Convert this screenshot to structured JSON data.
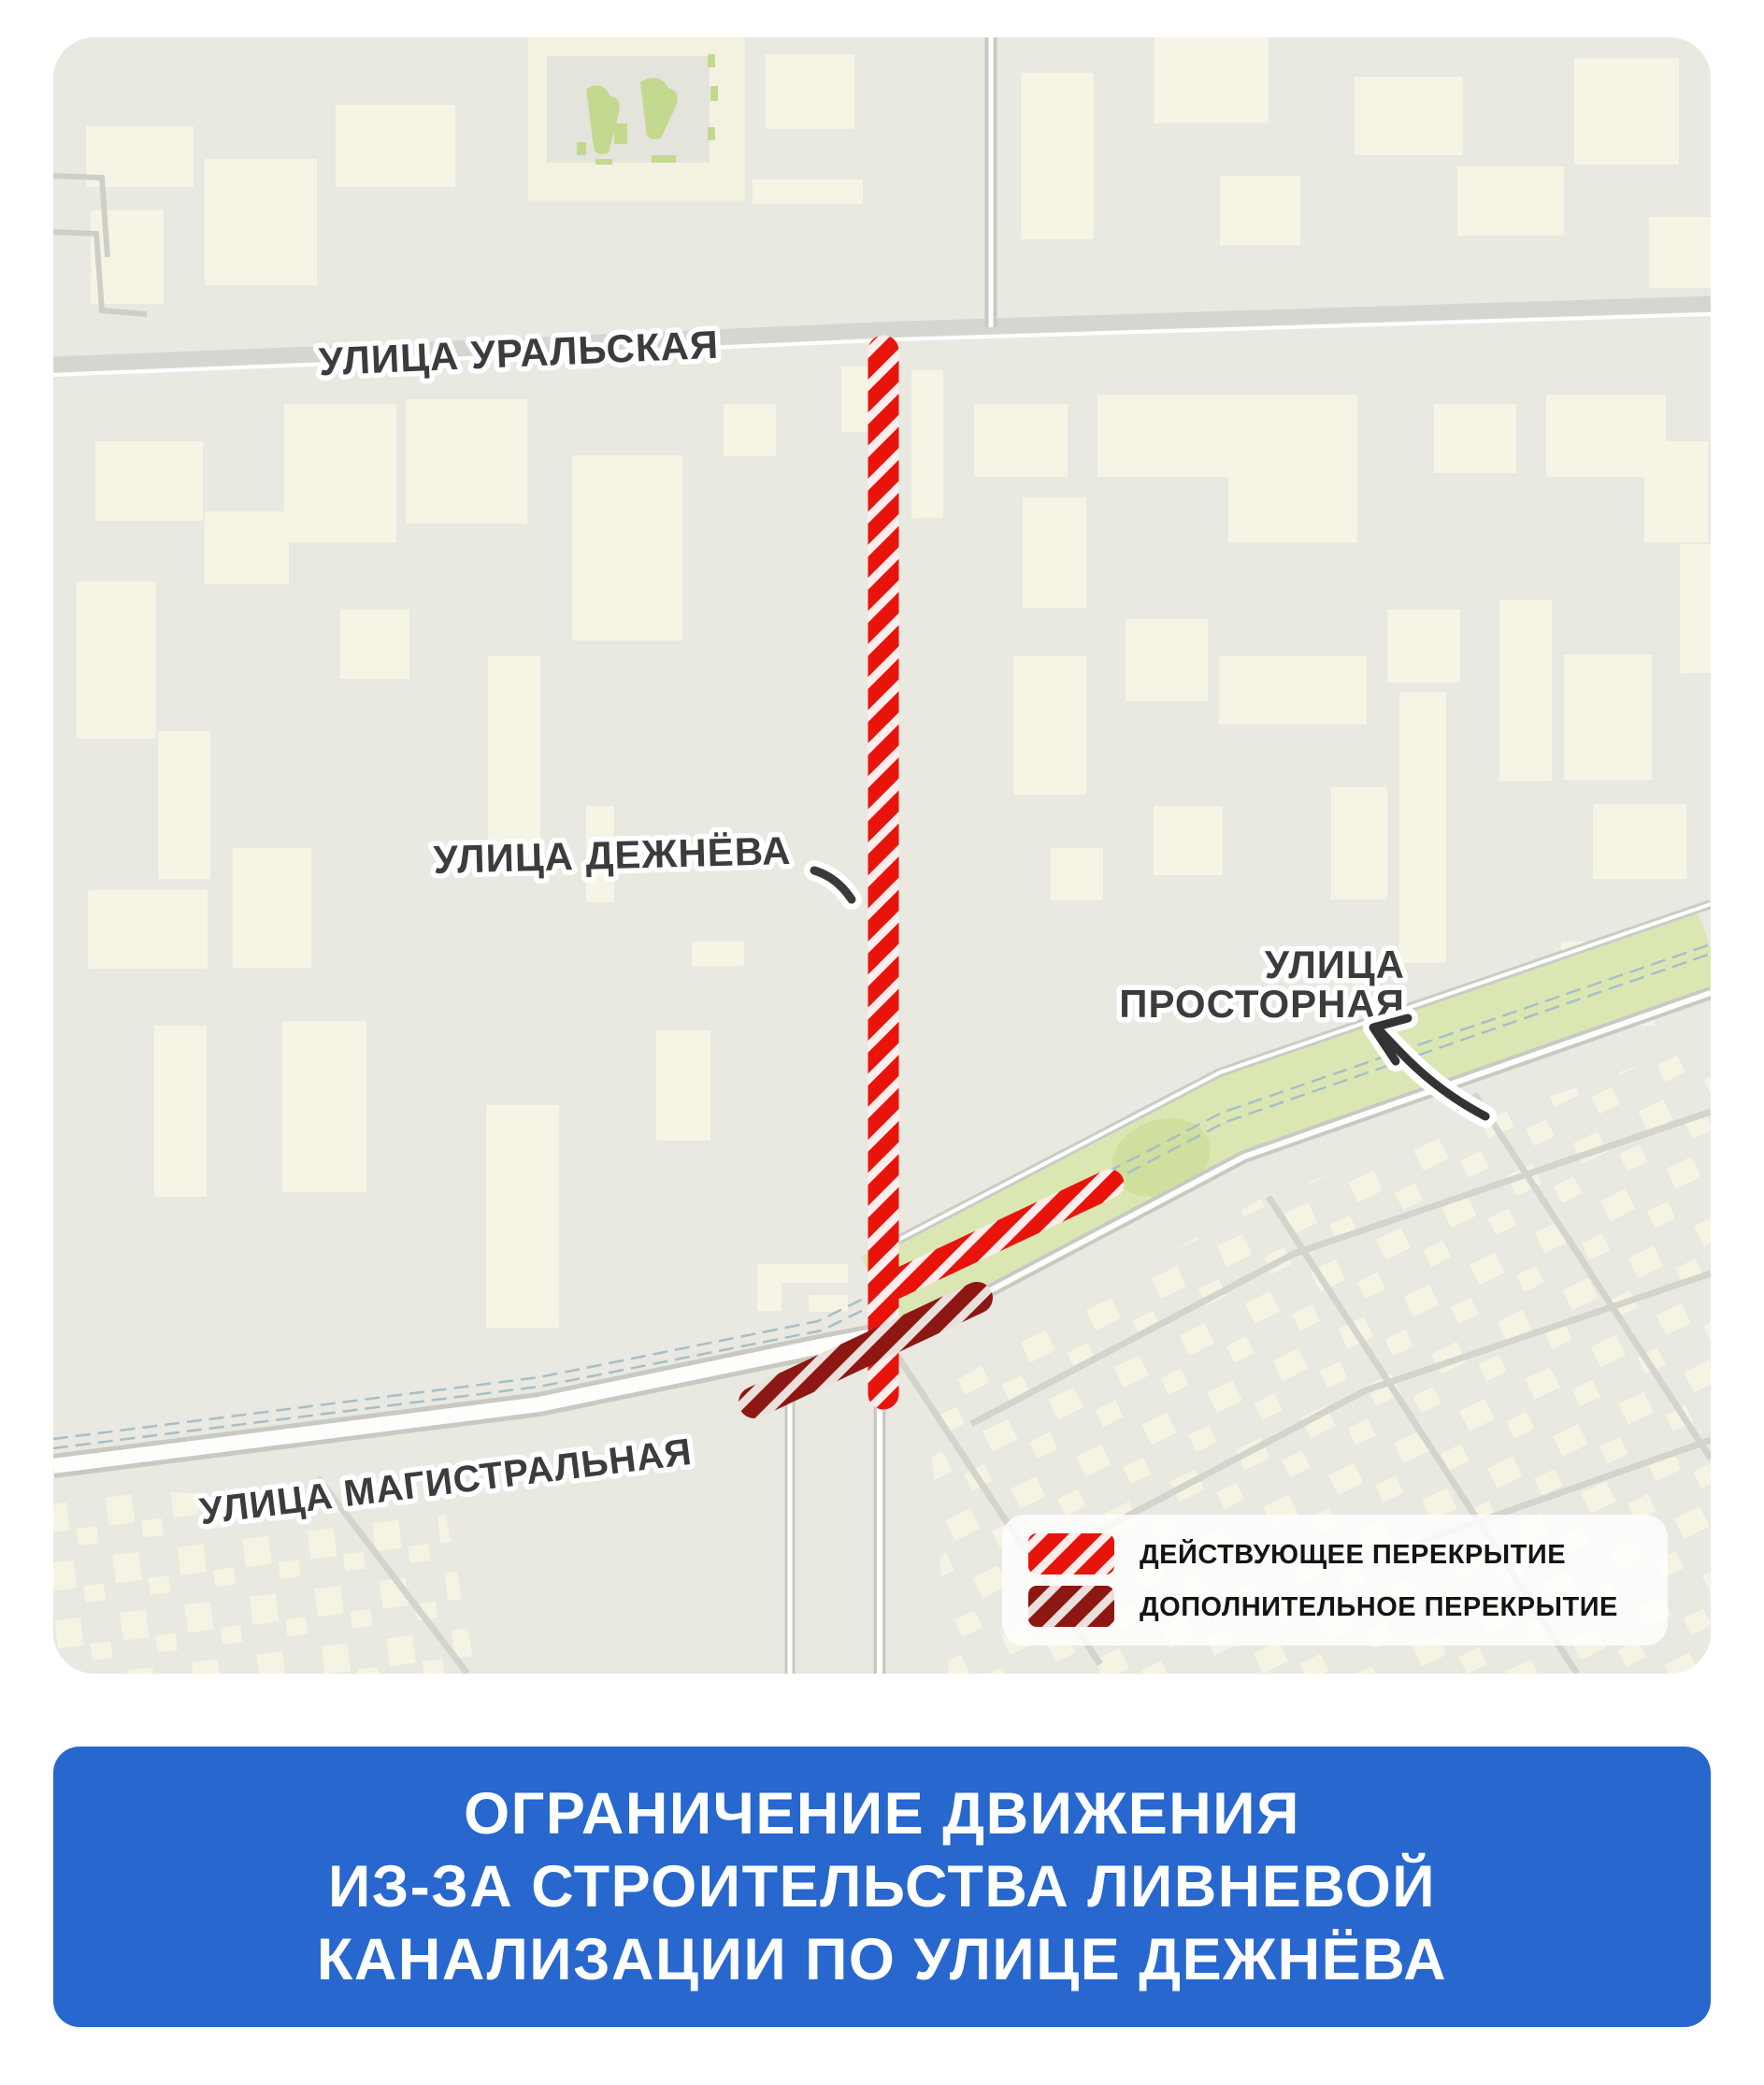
{
  "map": {
    "street_labels": {
      "uralskaya": "УЛИЦА УРАЛЬСКАЯ",
      "dezhneva": "УЛИЦА ДЕЖНЁВА",
      "prostornaya_line1": "УЛИЦА",
      "prostornaya_line2": "ПРОСТОРНАЯ",
      "magistralnaya": "УЛИЦА МАГИСТРАЛЬНАЯ"
    },
    "legend": {
      "active_label": "ДЕЙСТВУЮЩЕЕ ПЕРЕКРЫТИЕ",
      "additional_label": "ДОПОЛНИТЕЛЬНОЕ ПЕРЕКРЫТИЕ",
      "active_color": "#e8140c",
      "additional_color": "#8d1712"
    }
  },
  "banner": {
    "lines": [
      "ОГРАНИЧЕНИЕ ДВИЖЕНИЯ",
      "ИЗ-ЗА СТРОИТЕЛЬСТВА ЛИВНЕВОЙ",
      "КАНАЛИЗАЦИИ ПО УЛИЦЕ ДЕЖНЁВА"
    ],
    "background": "#2767ce",
    "text_color": "#ffffff"
  }
}
